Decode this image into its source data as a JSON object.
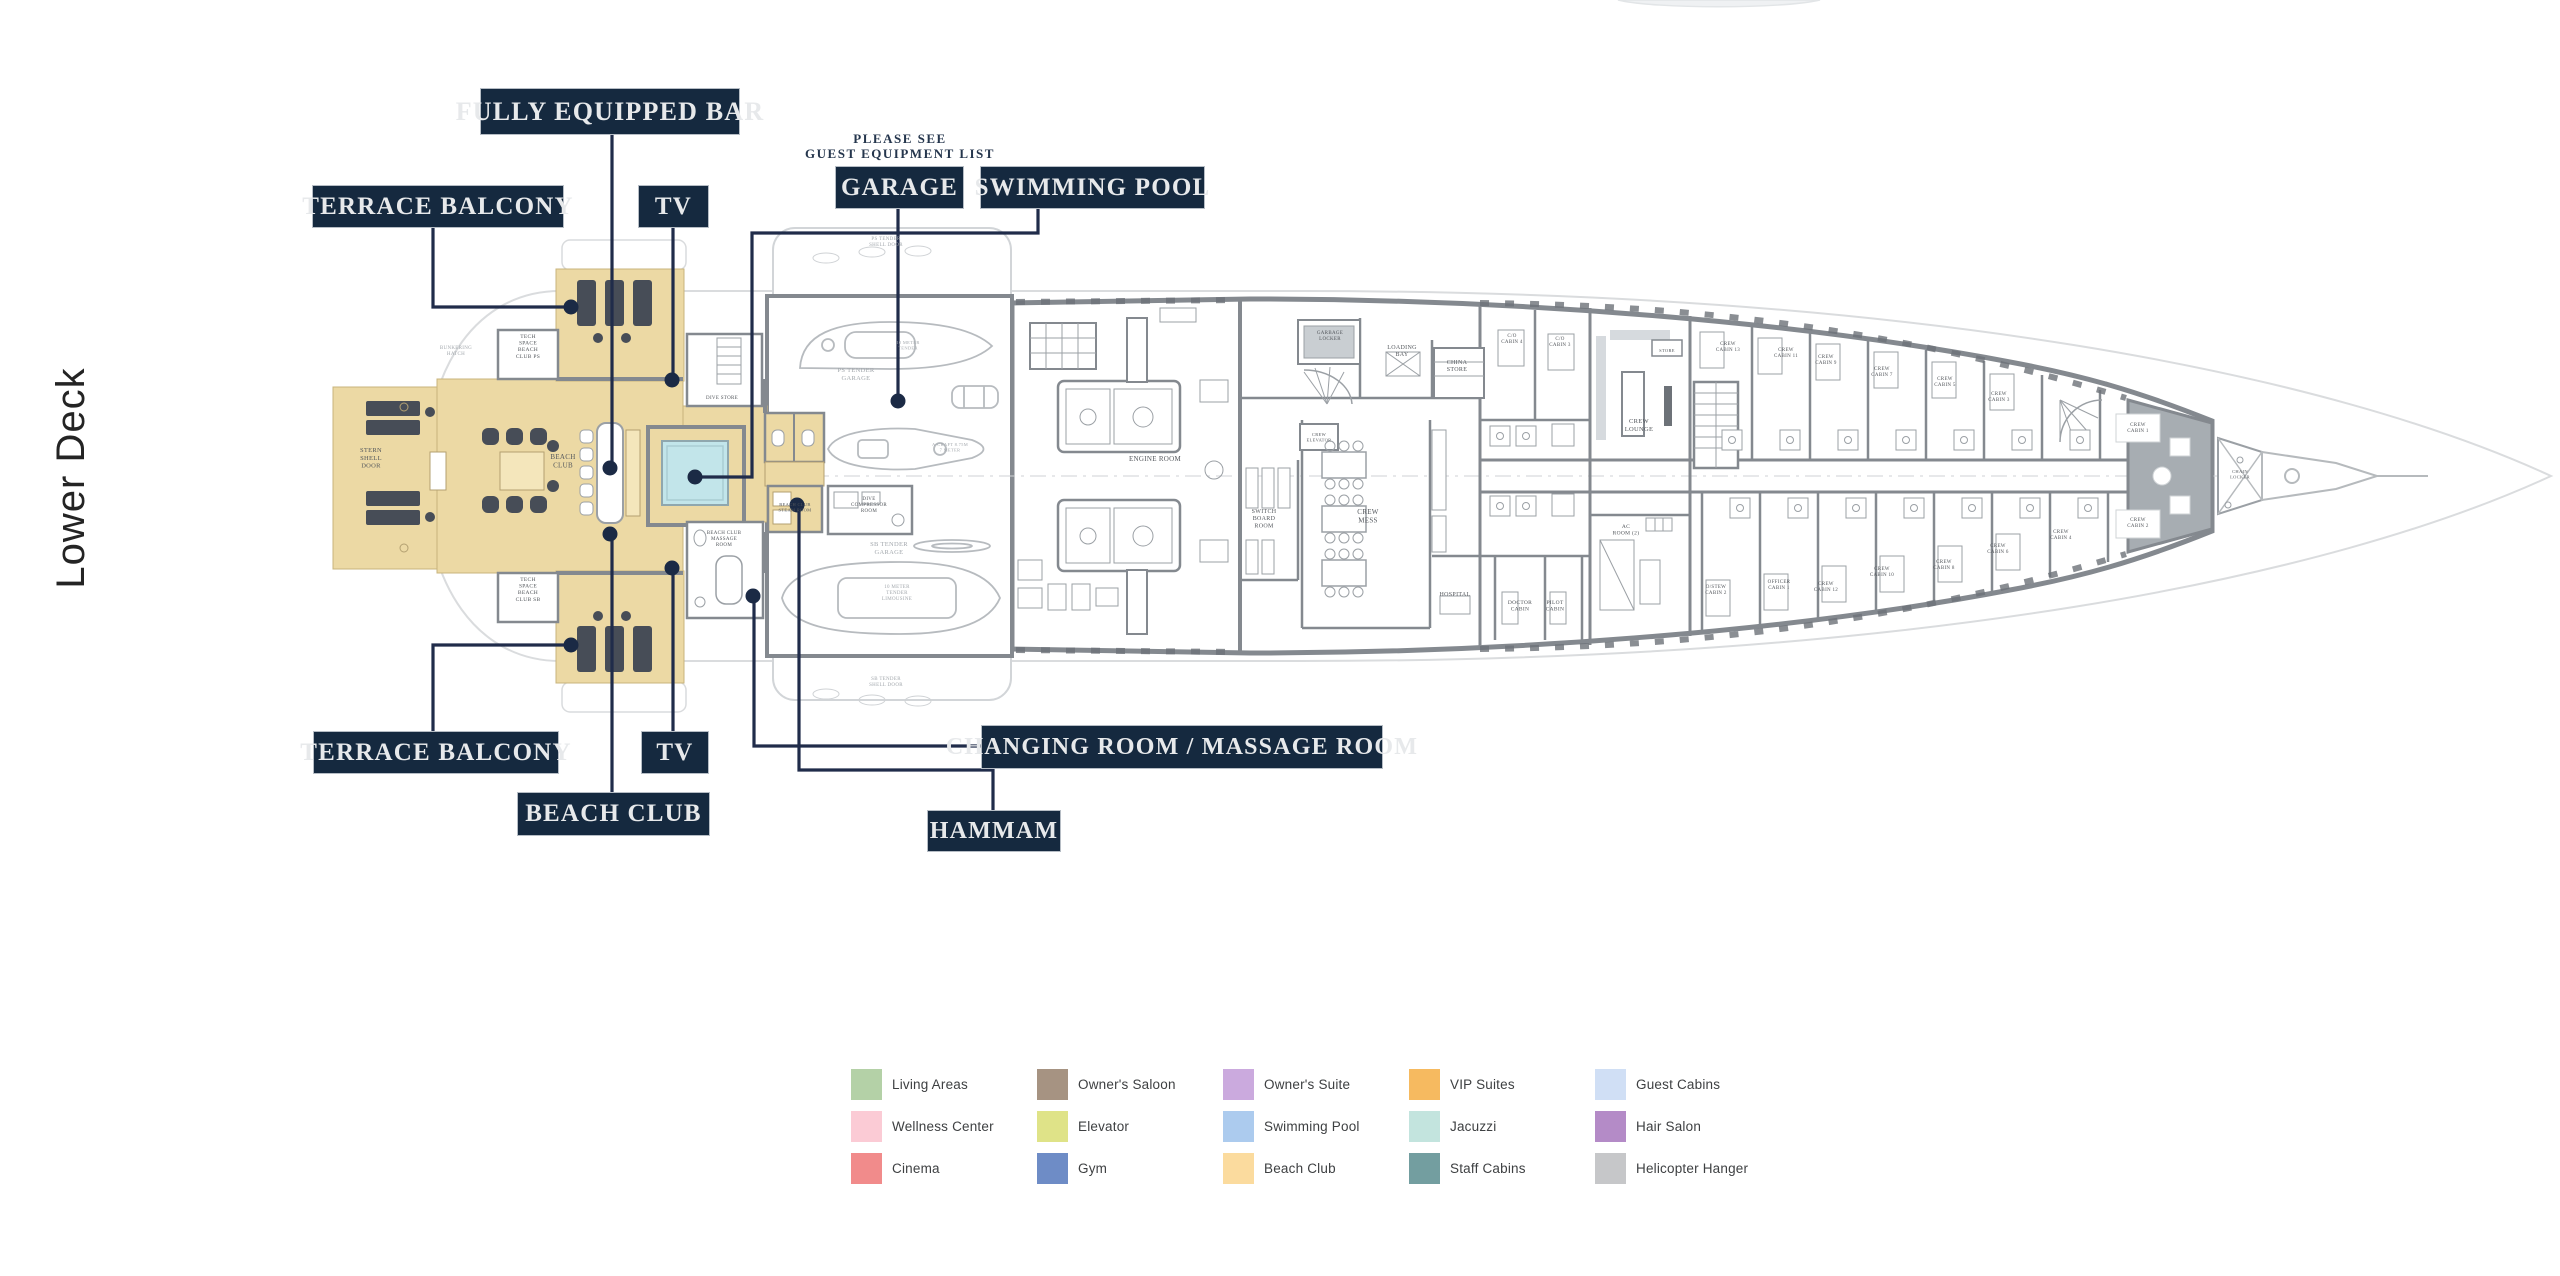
{
  "page": {
    "title_vertical": "Lower Deck",
    "background": "#ffffff"
  },
  "callouts": {
    "fully_equipped_bar": "FULLY EQUIPPED BAR",
    "terrace_balcony_top": "TERRACE BALCONY",
    "tv_top": "TV",
    "garage": "GARAGE",
    "swimming_pool": "SWIMMING POOL",
    "terrace_balcony_bottom": "TERRACE BALCONY",
    "tv_bottom": "TV",
    "beach_club": "BEACH CLUB",
    "changing_room": "CHANGING ROOM / MASSAGE ROOM",
    "hammam": "HAMMAM"
  },
  "note": {
    "line1": "PLEASE SEE",
    "line2": "GUEST EQUIPMENT LIST"
  },
  "legend": {
    "items": [
      {
        "label": "Living Areas",
        "color": "#b4d1a7"
      },
      {
        "label": "Wellness Center",
        "color": "#fbcbd5"
      },
      {
        "label": "Cinema",
        "color": "#f18b8b"
      },
      {
        "label": "Owner's Saloon",
        "color": "#a69382"
      },
      {
        "label": "Elevator",
        "color": "#dfe388"
      },
      {
        "label": "Gym",
        "color": "#6e8cc6"
      },
      {
        "label": "Owner's Suite",
        "color": "#cbaade"
      },
      {
        "label": "Swimming Pool",
        "color": "#accbee"
      },
      {
        "label": "Beach Club",
        "color": "#fbdb9e"
      },
      {
        "label": "VIP Suites",
        "color": "#f6ba60"
      },
      {
        "label": "Jacuzzi",
        "color": "#c3e4de"
      },
      {
        "label": "Staff Cabins",
        "color": "#739ea0"
      },
      {
        "label": "Guest Cabins",
        "color": "#d0dff5"
      },
      {
        "label": "Hair Salon",
        "color": "#b48bc7"
      },
      {
        "label": "Helicopter Hanger",
        "color": "#c6c7c9"
      }
    ]
  },
  "plan": {
    "colors": {
      "wall": "#84898f",
      "beach_club_fill": "#ecd9a4",
      "pool_fill": "#c2e5ea",
      "lounger": "#474d57",
      "leader_line": "#202c4a",
      "hull_outline": "#dadcde",
      "room_label": "#53575c"
    },
    "rooms": [
      {
        "t": "STERN\nSHELL\nDOOR",
        "x": 371,
        "y": 452,
        "fs": 6.5
      },
      {
        "t": "BUNKERING\nHATCH",
        "x": 456,
        "y": 349,
        "fs": 5,
        "muted": true
      },
      {
        "t": "TECH\nSPACE\nBEACH\nCLUB PS",
        "x": 528,
        "y": 338,
        "fs": 5.5
      },
      {
        "t": "TECH\nSPACE\nBEACH\nCLUB SB",
        "x": 528,
        "y": 581,
        "fs": 5.5
      },
      {
        "t": "BEACH\nCLUB",
        "x": 563,
        "y": 459,
        "fs": 7
      },
      {
        "t": "DIVE STORE",
        "x": 722,
        "y": 399,
        "fs": 5
      },
      {
        "t": "BEACH CLUB\nMASSAGE\nROOM",
        "x": 724,
        "y": 534,
        "fs": 5
      },
      {
        "t": "BEACH CLUB\nSTEAM ROOM",
        "x": 795,
        "y": 506,
        "fs": 4.5
      },
      {
        "t": "PS TENDER\nSHELL DOOR",
        "x": 886,
        "y": 240,
        "fs": 5,
        "muted": true
      },
      {
        "t": "SB TENDER\nSHELL DOOR",
        "x": 886,
        "y": 680,
        "fs": 5,
        "muted": true
      },
      {
        "t": "PS TENDER\nGARAGE",
        "x": 856,
        "y": 372,
        "fs": 6.5,
        "muted": true
      },
      {
        "t": "10 METER\nTENDER",
        "x": 908,
        "y": 344,
        "fs": 4.5,
        "muted": true
      },
      {
        "t": "A-CRAFT 8.75M\n7 METER",
        "x": 950,
        "y": 446,
        "fs": 4.5,
        "muted": true
      },
      {
        "t": "DIVE\nCOMPRESSOR\nROOM",
        "x": 869,
        "y": 500,
        "fs": 5
      },
      {
        "t": "SB TENDER\nGARAGE",
        "x": 889,
        "y": 546,
        "fs": 6.5,
        "muted": true
      },
      {
        "t": "10 METER\nTENDER\nLIMOUSINE",
        "x": 897,
        "y": 588,
        "fs": 5,
        "muted": true
      },
      {
        "t": "ENGINE ROOM",
        "x": 1155,
        "y": 461,
        "fs": 7
      },
      {
        "t": "SWITCH\nBOARD\nROOM",
        "x": 1264,
        "y": 513,
        "fs": 6
      },
      {
        "t": "GARBAGE\nLOCKER",
        "x": 1330,
        "y": 334,
        "fs": 5
      },
      {
        "t": "LOADING\nBAY",
        "x": 1402,
        "y": 349,
        "fs": 6
      },
      {
        "t": "CHINA\nSTORE",
        "x": 1457,
        "y": 364,
        "fs": 6
      },
      {
        "t": "CREW\nELEVATOR",
        "x": 1319,
        "y": 436,
        "fs": 4.5
      },
      {
        "t": "CREW\nMESS",
        "x": 1368,
        "y": 514,
        "fs": 7
      },
      {
        "t": "HOSPITAL",
        "x": 1455,
        "y": 596,
        "fs": 6
      },
      {
        "t": "DOCTOR\nCABIN",
        "x": 1520,
        "y": 604,
        "fs": 5.5
      },
      {
        "t": "PILOT\nCABIN",
        "x": 1555,
        "y": 604,
        "fs": 5.5
      },
      {
        "t": "C/O\nCABIN 4",
        "x": 1512,
        "y": 337,
        "fs": 5
      },
      {
        "t": "C/O\nCABIN 3",
        "x": 1560,
        "y": 340,
        "fs": 5
      },
      {
        "t": "CREW\nLOUNGE",
        "x": 1639,
        "y": 423,
        "fs": 6.5
      },
      {
        "t": "STORE",
        "x": 1667,
        "y": 352,
        "fs": 4.5
      },
      {
        "t": "AC\nROOM (2)",
        "x": 1626,
        "y": 528,
        "fs": 5.5
      },
      {
        "t": "O/STEW\nCABIN 2",
        "x": 1716,
        "y": 588,
        "fs": 5
      },
      {
        "t": "CREW\nCABIN 13",
        "x": 1728,
        "y": 345,
        "fs": 5
      },
      {
        "t": "CREW\nCABIN 11",
        "x": 1786,
        "y": 351,
        "fs": 5
      },
      {
        "t": "CREW\nCABIN 9",
        "x": 1826,
        "y": 358,
        "fs": 5
      },
      {
        "t": "CREW\nCABIN 7",
        "x": 1882,
        "y": 370,
        "fs": 5
      },
      {
        "t": "CREW\nCABIN 5",
        "x": 1945,
        "y": 380,
        "fs": 5
      },
      {
        "t": "CREW\nCABIN 3",
        "x": 1999,
        "y": 395,
        "fs": 5
      },
      {
        "t": "CREW\nCABIN 1",
        "x": 2138,
        "y": 426,
        "fs": 5
      },
      {
        "t": "OFFICER\nCABIN 1",
        "x": 1779,
        "y": 583,
        "fs": 5
      },
      {
        "t": "CREW\nCABIN 12",
        "x": 1826,
        "y": 585,
        "fs": 5
      },
      {
        "t": "CREW\nCABIN 10",
        "x": 1882,
        "y": 570,
        "fs": 5
      },
      {
        "t": "CREW\nCABIN 8",
        "x": 1944,
        "y": 563,
        "fs": 5
      },
      {
        "t": "CREW\nCABIN 6",
        "x": 1998,
        "y": 547,
        "fs": 5
      },
      {
        "t": "CREW\nCABIN 4",
        "x": 2061,
        "y": 533,
        "fs": 5
      },
      {
        "t": "CREW\nCABIN 2",
        "x": 2138,
        "y": 521,
        "fs": 5
      },
      {
        "t": "CHAIN\nLOCKER",
        "x": 2240,
        "y": 473,
        "fs": 4.5
      }
    ]
  }
}
